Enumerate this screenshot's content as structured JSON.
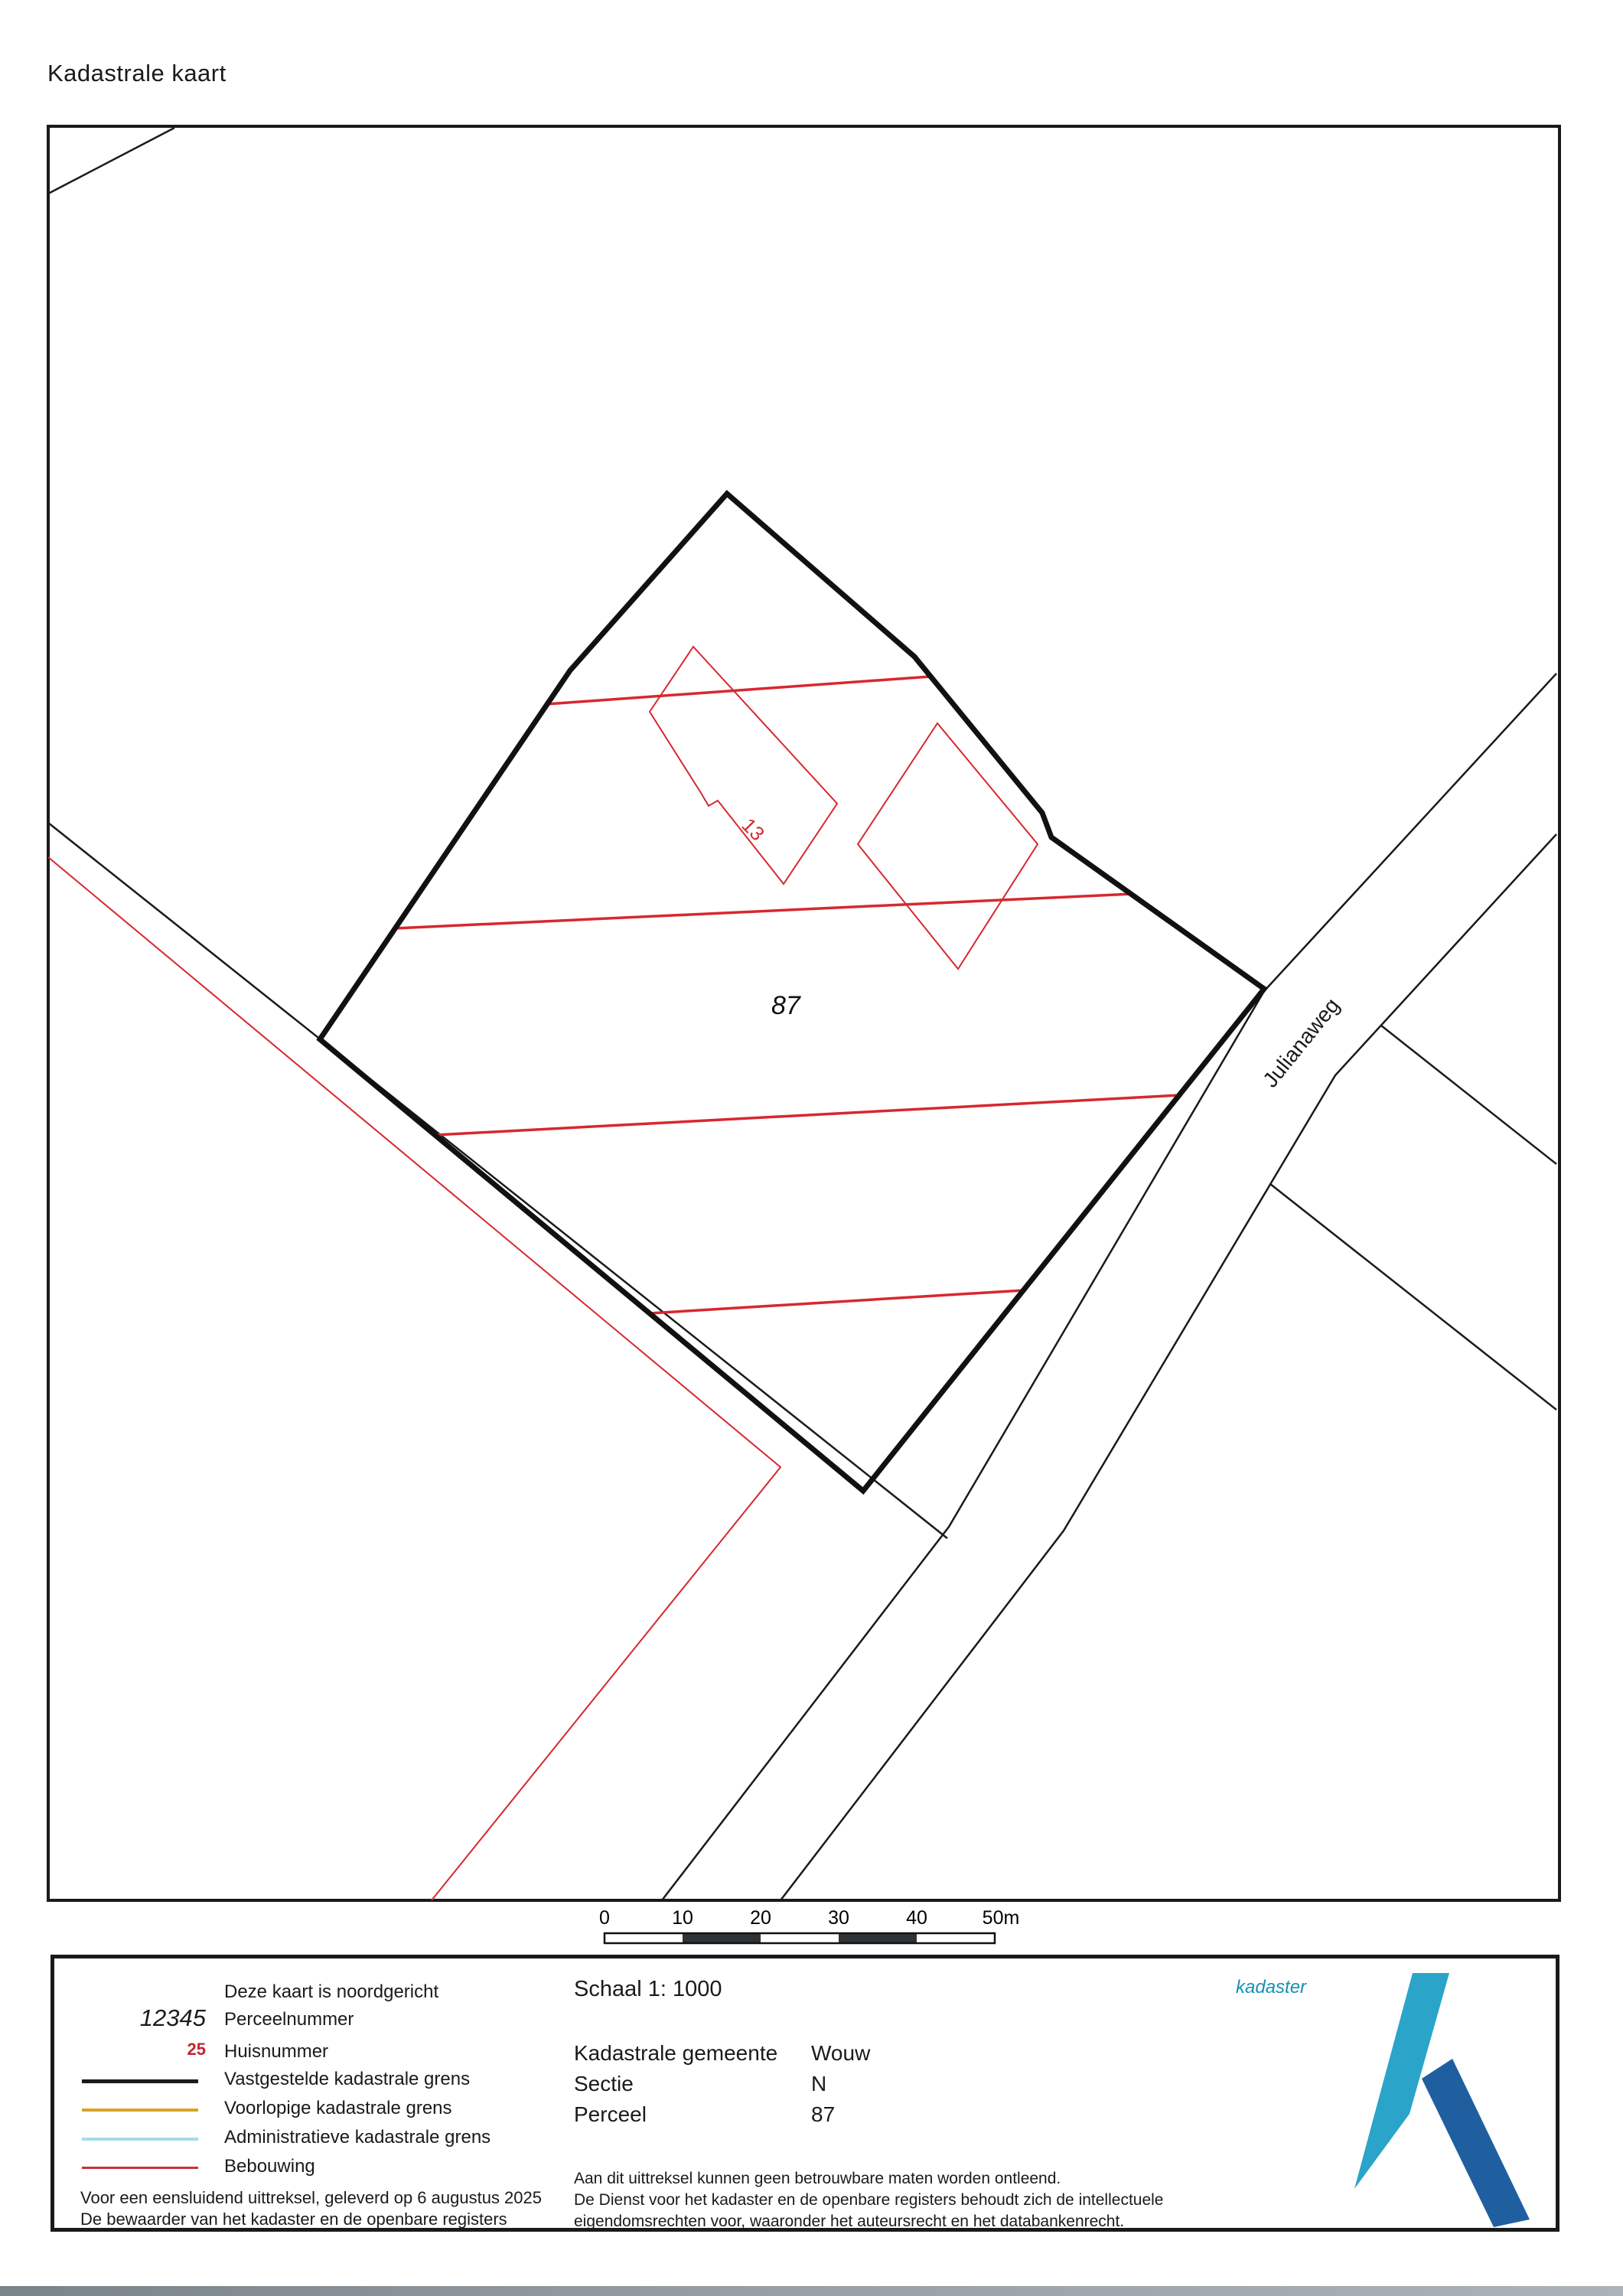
{
  "page": {
    "title": "Kadastrale kaart"
  },
  "map": {
    "parcel_number": "87",
    "house_number": "13",
    "street_label": "Julianaweg",
    "boundary_color": "#111111",
    "building_color": "#d7282f"
  },
  "scalebar": {
    "ticks": [
      "0",
      "10",
      "20",
      "30",
      "40",
      "50m"
    ]
  },
  "legend": {
    "north_note": "Deze kaart is noordgericht",
    "parcel_sample": "12345",
    "parcel_label": "Perceelnummer",
    "house_sample": "25",
    "house_label": "Huisnummer",
    "line_items": [
      {
        "label": "Vastgestelde kadastrale grens",
        "color": "#1a1a1a"
      },
      {
        "label": "Voorlopige kadastrale grens",
        "color": "#d9a427"
      },
      {
        "label": "Administratieve kadastrale grens",
        "color": "#a5dde6"
      },
      {
        "label": "Bebouwing",
        "color": "#c8323e"
      }
    ],
    "issued_line1": "Voor een eensluidend uittreksel, geleverd op 6 augustus 2025",
    "issued_line2": "De bewaarder van het kadaster en de openbare registers",
    "scale_text": "Schaal 1: 1000",
    "rows": [
      {
        "label": "Kadastrale gemeente",
        "value": "Wouw"
      },
      {
        "label": "Sectie",
        "value": "N"
      },
      {
        "label": "Perceel",
        "value": "87"
      }
    ],
    "disclaimer1": "Aan dit uittreksel kunnen geen betrouwbare maten worden ontleend.",
    "disclaimer2": "De Dienst voor het kadaster en de openbare registers behoudt zich de intellectuele",
    "disclaimer3": "eigendomsrechten voor, waaronder het auteursrecht en het databankenrecht.",
    "logo_text": "kadaster",
    "logo_colors": {
      "text": "#1590b4",
      "blade": "#2aa4c8",
      "leg": "#1f5fa0"
    }
  }
}
